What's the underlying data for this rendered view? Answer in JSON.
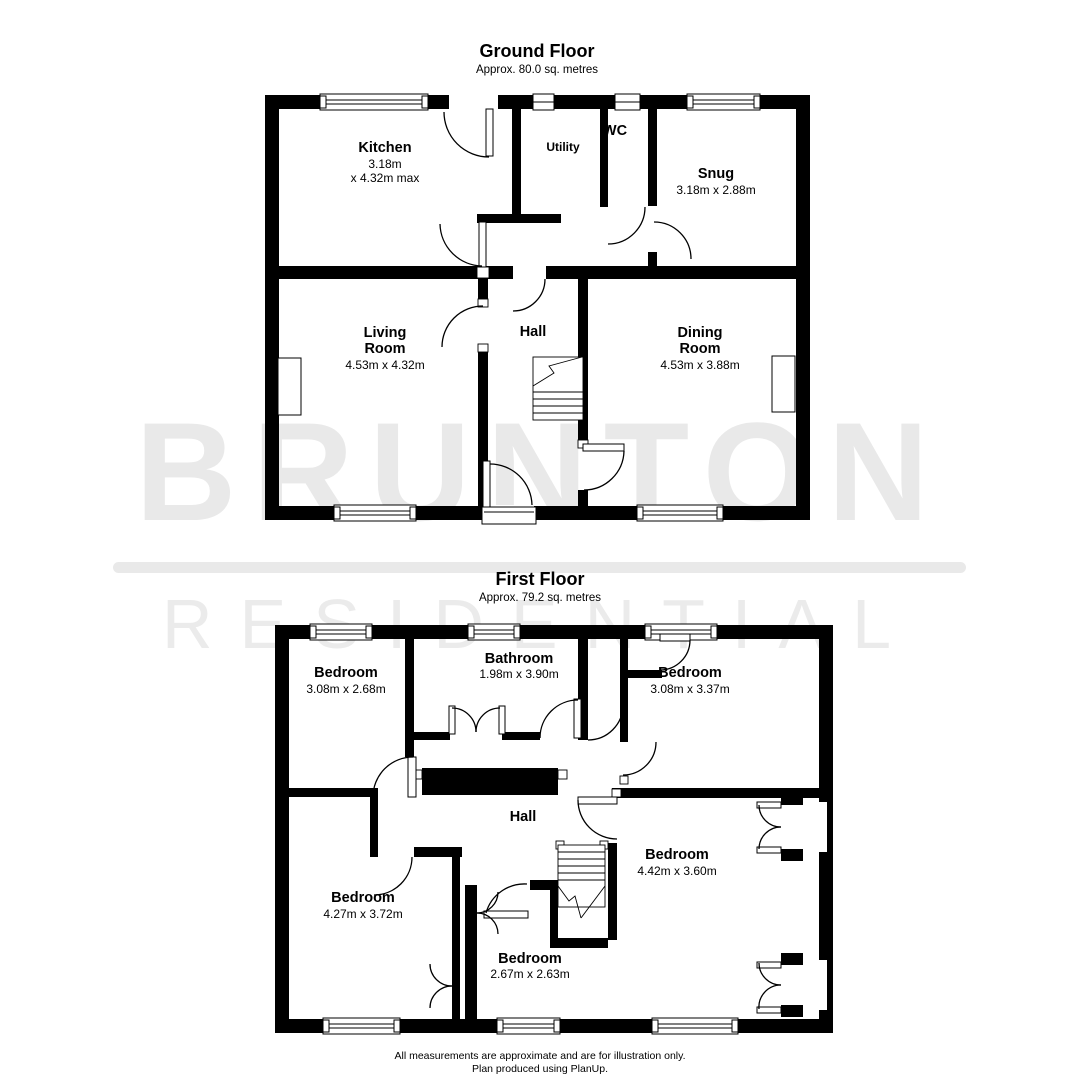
{
  "watermark": {
    "brand": "BRUNTON",
    "sub": "RESIDENTIAL",
    "color": "#e9e9e9"
  },
  "plan_line_color": "#000000",
  "titles": {
    "ground": {
      "title": "Ground Floor",
      "area": "Approx. 80.0 sq. metres"
    },
    "first": {
      "title": "First Floor",
      "area": "Approx. 79.2 sq. metres"
    }
  },
  "gf": {
    "kitchen": {
      "name": "Kitchen",
      "dim1": "3.18m",
      "dim2": "x 4.32m max"
    },
    "utility": {
      "name": "Utility"
    },
    "wc": {
      "name": "WC"
    },
    "snug": {
      "name": "Snug",
      "dim1": "3.18m x 2.88m"
    },
    "living": {
      "name1": "Living",
      "name2": "Room",
      "dim1": "4.53m x 4.32m"
    },
    "hall": {
      "name": "Hall"
    },
    "dining": {
      "name1": "Dining",
      "name2": "Room",
      "dim1": "4.53m x 3.88m"
    }
  },
  "ff": {
    "bedroom_tl": {
      "name": "Bedroom",
      "dim1": "3.08m x 2.68m"
    },
    "bathroom": {
      "name": "Bathroom",
      "dim1": "1.98m x 3.90m"
    },
    "bedroom_tr": {
      "name": "Bedroom",
      "dim1": "3.08m x 3.37m"
    },
    "hall": {
      "name": "Hall"
    },
    "bedroom_bl": {
      "name": "Bedroom",
      "dim1": "4.27m x 3.72m"
    },
    "bedroom_small": {
      "name": "Bedroom",
      "dim1": "2.67m x 2.63m"
    },
    "bedroom_br": {
      "name": "Bedroom",
      "dim1": "4.42m x 3.60m"
    }
  },
  "footer": {
    "line1": "All measurements are approximate and are for illustration only.",
    "line2": "Plan produced using PlanUp."
  }
}
